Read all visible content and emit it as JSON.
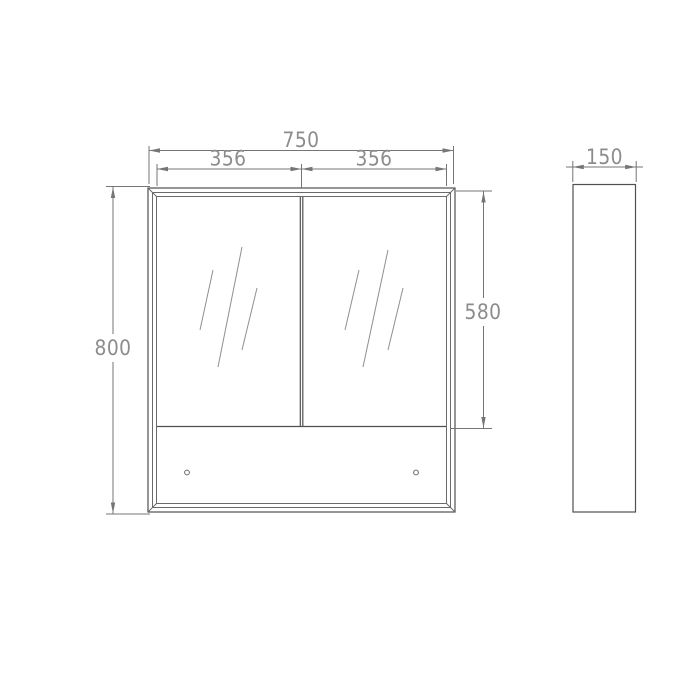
{
  "dimensions": {
    "overall_width": "750",
    "left_door_width": "356",
    "right_door_width": "356",
    "overall_height": "800",
    "door_height": "580",
    "depth": "150"
  },
  "colors": {
    "object_line": "#4f4f4f",
    "frame_line": "#6a6a6a",
    "dimension_line": "#757575",
    "dimension_text": "#8c8c8c",
    "hatch_line": "#8f8f8f",
    "background": "#ffffff"
  }
}
